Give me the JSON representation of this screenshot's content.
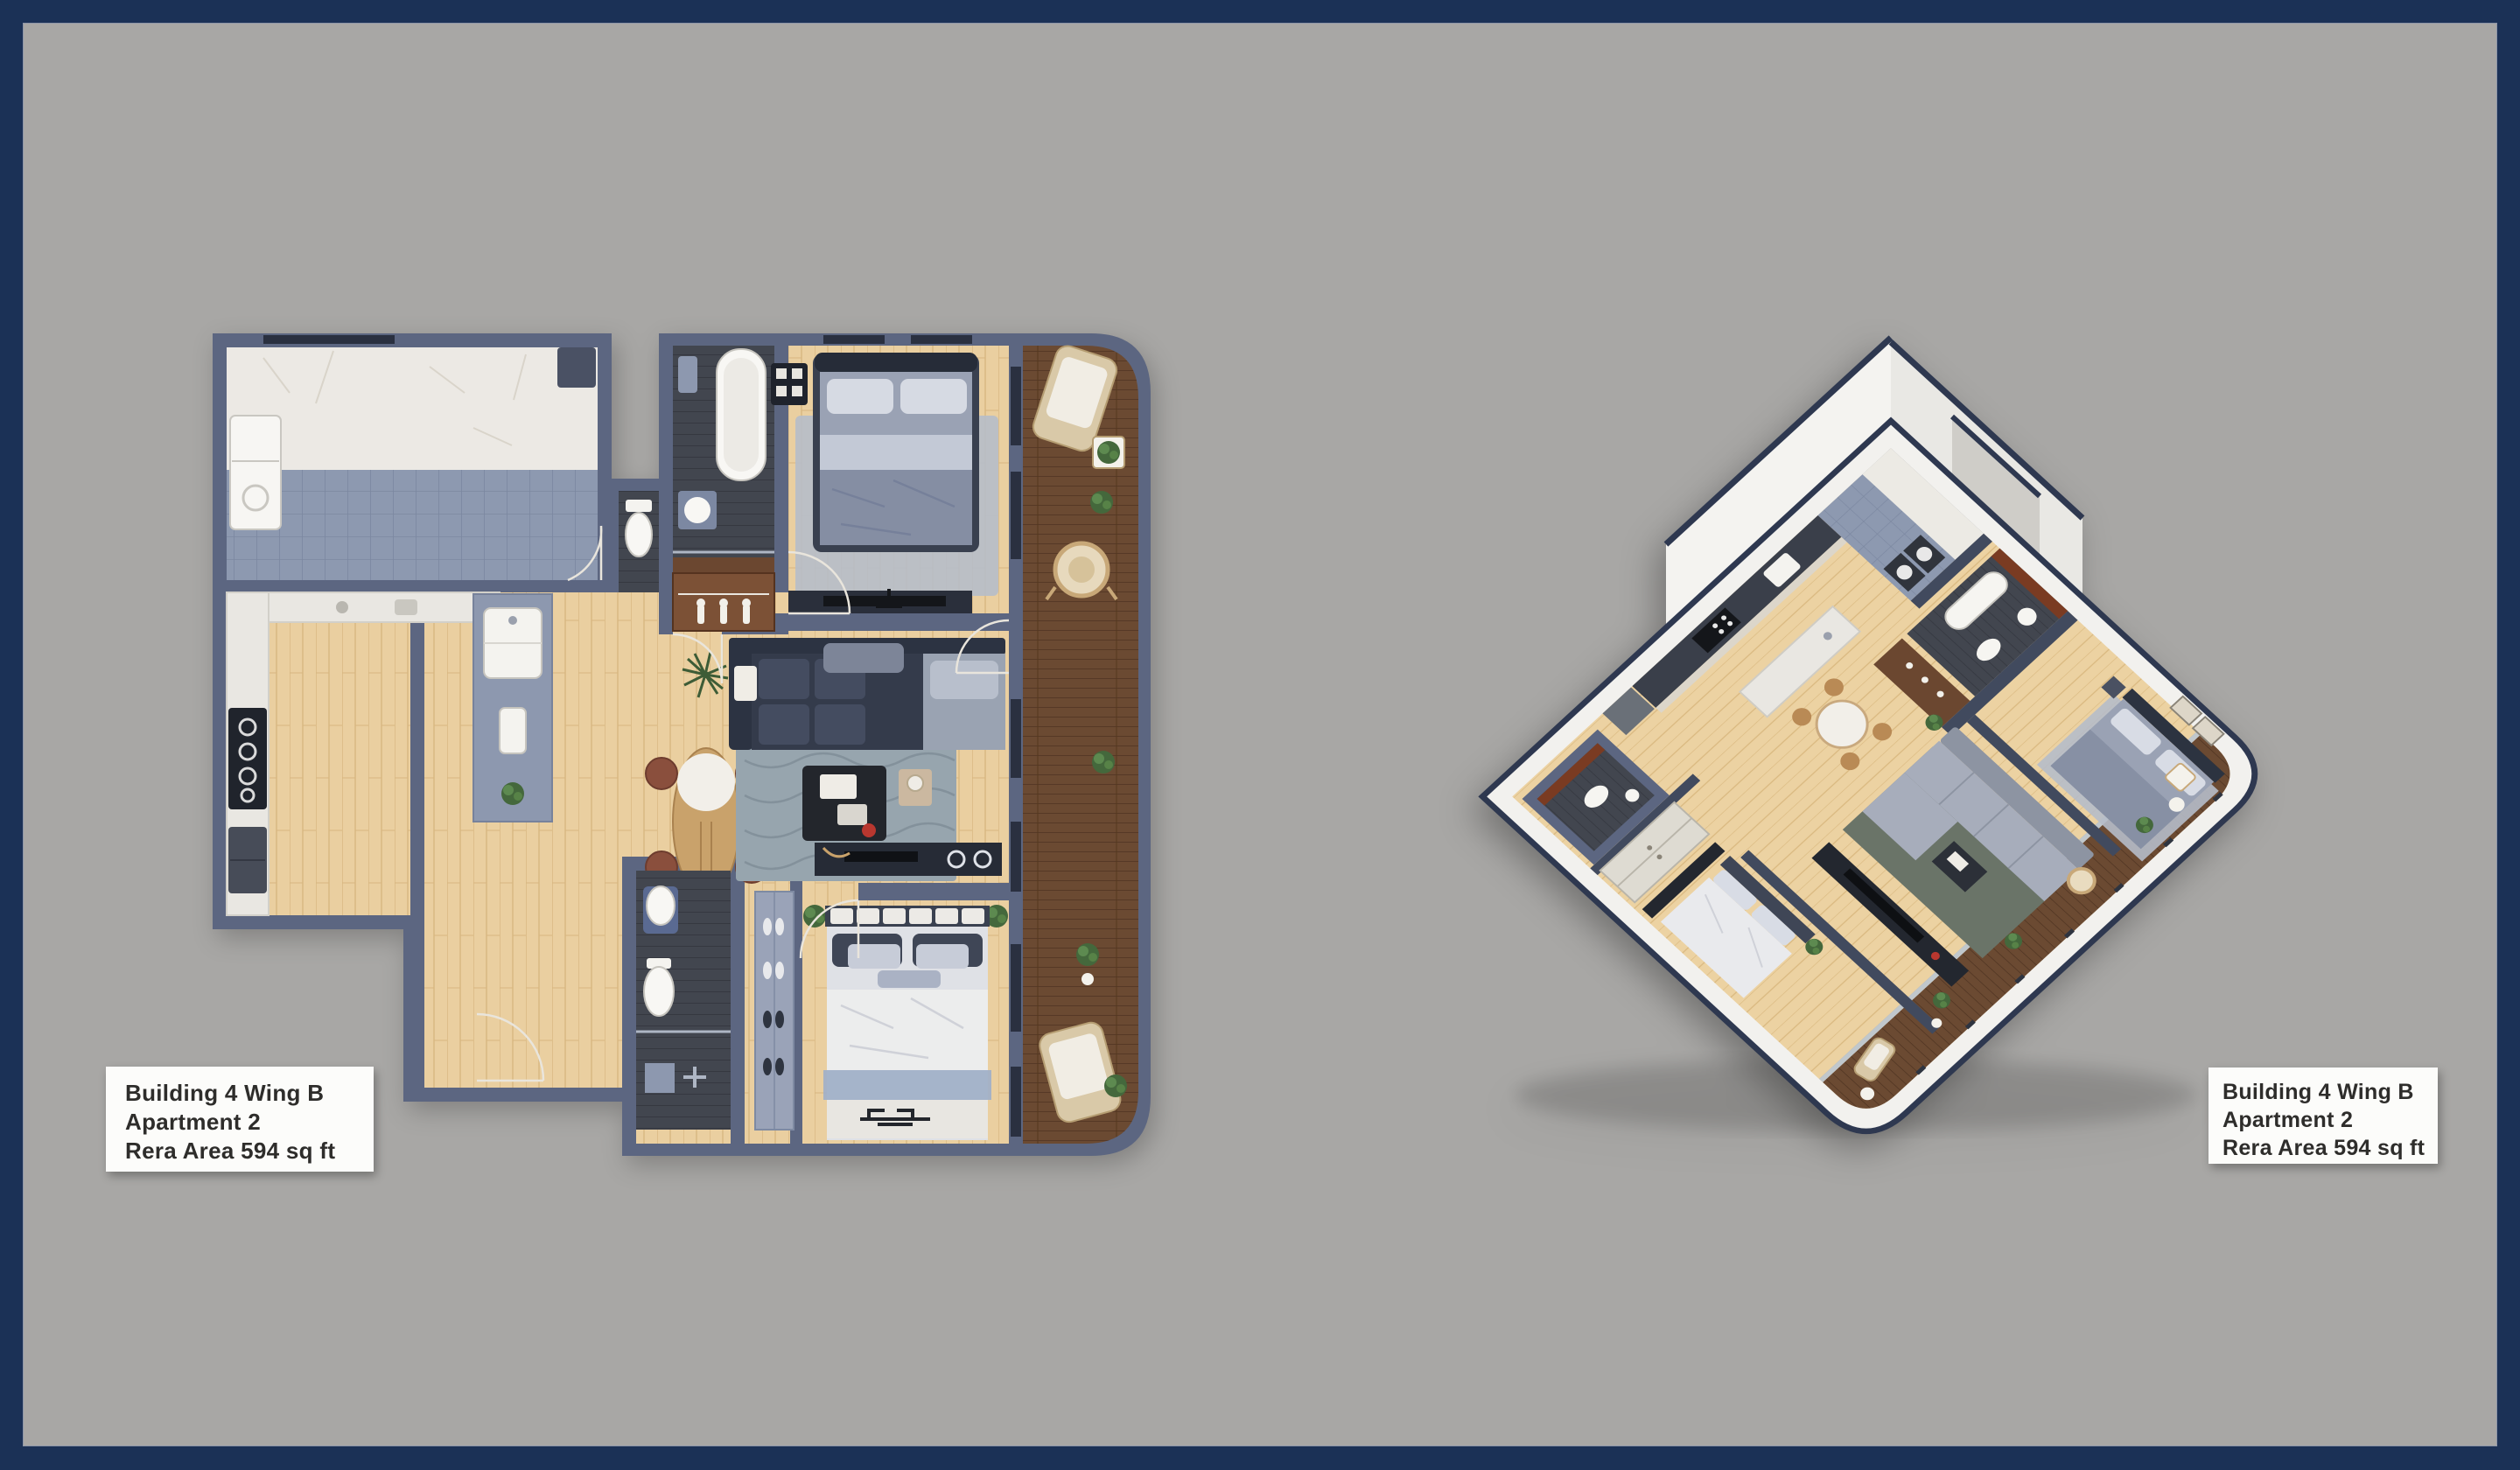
{
  "page": {
    "description": "Real-estate brochure slide with two renderings of the same apartment: a 2D top-down furnished floor plan (left) and a 3D isometric cutaway floor plan (right)",
    "background_color": "#a8a7a5",
    "frame_color": "#1b3156"
  },
  "annotations": {
    "left": {
      "lines": [
        "Building 4 Wing B",
        "Apartment 2",
        "Rera Area 594 sq ft"
      ]
    },
    "right": {
      "lines": [
        "Building 4 Wing B",
        "Apartment 2",
        "Rera Area 594 sq ft"
      ]
    }
  },
  "plans": {
    "left": {
      "name": "2D top-down floor plan",
      "view": "top-down",
      "rooms": [
        "bathroom with marble and tiled floor",
        "kitchen",
        "entry corridor",
        "powder toilet",
        "master bathroom with tub and shower",
        "wardrobe",
        "master bedroom",
        "living room",
        "dining area",
        "second bathroom",
        "shoe closet",
        "second bedroom",
        "wrap balcony deck"
      ],
      "furniture": [
        "washing machine",
        "cooktop with burners",
        "fridge",
        "kitchen island with sink",
        "oval dining table with four chairs",
        "L-shaped sofa",
        "area rug",
        "coffee table",
        "tv console",
        "double bed with pillows",
        "bedroom rug",
        "bathtub",
        "wash basin",
        "toilets",
        "second double bed",
        "bench rack",
        "sun loungers",
        "wicker chair",
        "potted plants"
      ]
    },
    "right": {
      "name": "3D isometric floor plan",
      "view": "isometric",
      "rooms": [
        "kitchen with cream cabinets",
        "laundry bathroom",
        "master bathroom with maroon accent wall",
        "master bedroom with framed art",
        "living room",
        "dining area",
        "second bathroom",
        "sliding-door closet",
        "second bedroom",
        "balcony deck with glass railing"
      ],
      "furniture": [
        "fridge",
        "gas cooktop",
        "washing machines",
        "wood wardrobe",
        "gray double bed",
        "sectional sofa",
        "dark rug",
        "tv console",
        "round dining table",
        "white double bed",
        "wicker hanging chair",
        "outdoor chair and table",
        "sun lounger",
        "potted plants"
      ]
    }
  },
  "palette": {
    "wall_slate": "#5c6681",
    "wall_white": "#f2f1ee",
    "wall_cap_navy": "#2e3850",
    "wood_floor": "#eacfa0",
    "deck_wood": "#6b4a32",
    "tile_blue": "#8d99b0",
    "dark_floor": "#42464f",
    "marble": "#ece9e4",
    "accent_maroon": "#7a3b22",
    "bed_gray": "#9aa2b4",
    "sofa_dark": "#343b4b",
    "label_bg": "#fcfcfa",
    "label_text": "#2e2d2b"
  }
}
